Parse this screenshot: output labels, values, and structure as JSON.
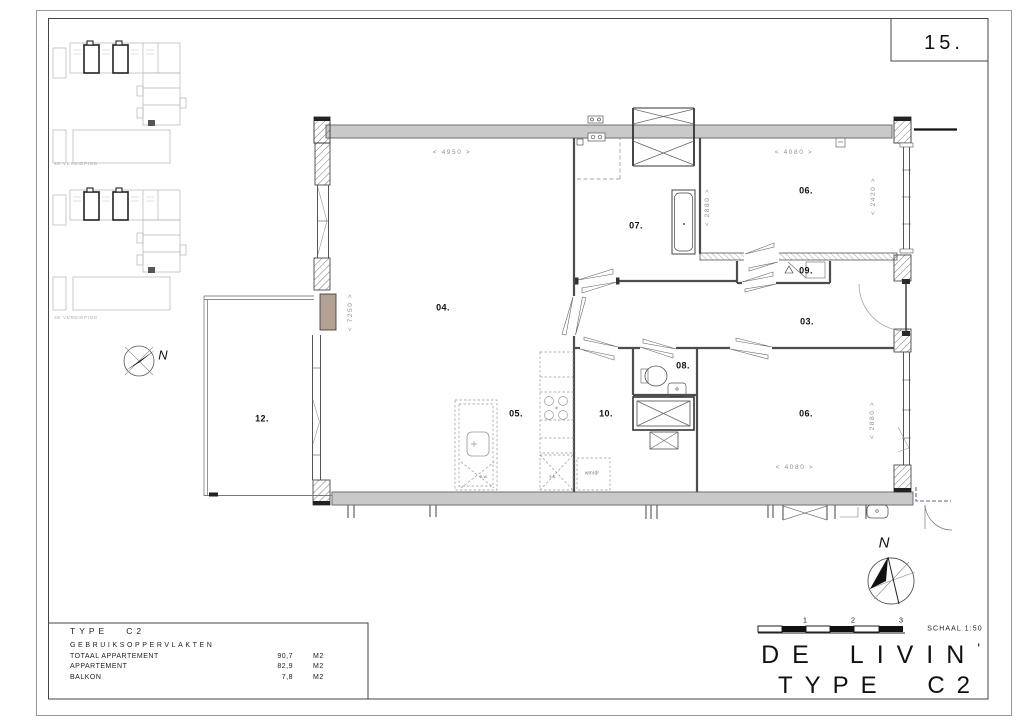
{
  "page": {
    "number": "15."
  },
  "key_plans": {
    "plan_a_caption": "2E VERDIEPING",
    "plan_b_caption": "4E VERDIEPING"
  },
  "compass": {
    "north_left": "N",
    "north_right": "N"
  },
  "plan": {
    "rooms": {
      "r03": "03.",
      "r04": "04.",
      "r05": "05.",
      "r06a": "06.",
      "r06b": "06.",
      "r07": "07.",
      "r08": "08.",
      "r09": "09.",
      "r10": "10.",
      "r12": "12."
    },
    "dimensions": {
      "d4950": "< 4950 >",
      "d7250": "< 7250 >",
      "d4080a": "< 4080 >",
      "d2880a": "< 2880 >",
      "d2420": "< 2420 >",
      "d4080b": "< 4080 >",
      "d2880b": "< 2880 >"
    },
    "fixtures": {
      "washer_dryer": "wm/dr",
      "fridge": "k.k.",
      "island_sink": "k.w."
    },
    "colors": {
      "wall_fill": "#c9c9c9",
      "wood_accent": "#b3a294",
      "annotation_blue": "#5b5bd6"
    }
  },
  "area_table": {
    "type_label": "TYPE",
    "type_value": "C2",
    "header": "GEBRUIKSOPPERVLAKTEN",
    "rows": [
      {
        "label": "TOTAAL APPARTEMENT",
        "value": "90,7",
        "unit": "M2"
      },
      {
        "label": "APPARTEMENT",
        "value": "82,9",
        "unit": "M2"
      },
      {
        "label": "BALKON",
        "value": "7,8",
        "unit": "M2"
      }
    ]
  },
  "scale_bar": {
    "ticks": [
      "1",
      "2",
      "3"
    ],
    "label": "SCHAAL 1:50"
  },
  "title_block": {
    "project": "DE LIVIN",
    "apostrophe": "'",
    "type": "TYPE C2"
  }
}
